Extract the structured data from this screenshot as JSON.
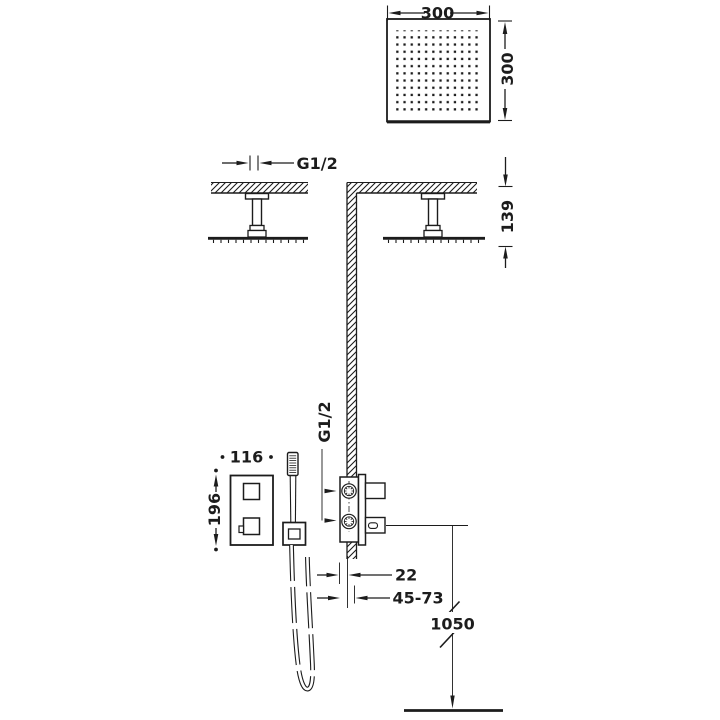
{
  "drawing_type": "shower-system-installation-dimensions",
  "colors": {
    "ink": "#1c1c1c",
    "background": "#ffffff"
  },
  "views": {
    "headshower_plan": {
      "width_mm": "300",
      "height_mm": "300"
    },
    "ceiling_section": {
      "thread_label": "G1/2",
      "ceiling_to_head_mm": "139"
    },
    "mixer_front": {
      "plate_width_mm": "116",
      "plate_height_mm": "196"
    },
    "mixer_side": {
      "thread_label": "G1/2",
      "wall_gap_mm": "22",
      "rough_in_range_mm": "45-73",
      "hose_length_mm": "1050"
    }
  }
}
